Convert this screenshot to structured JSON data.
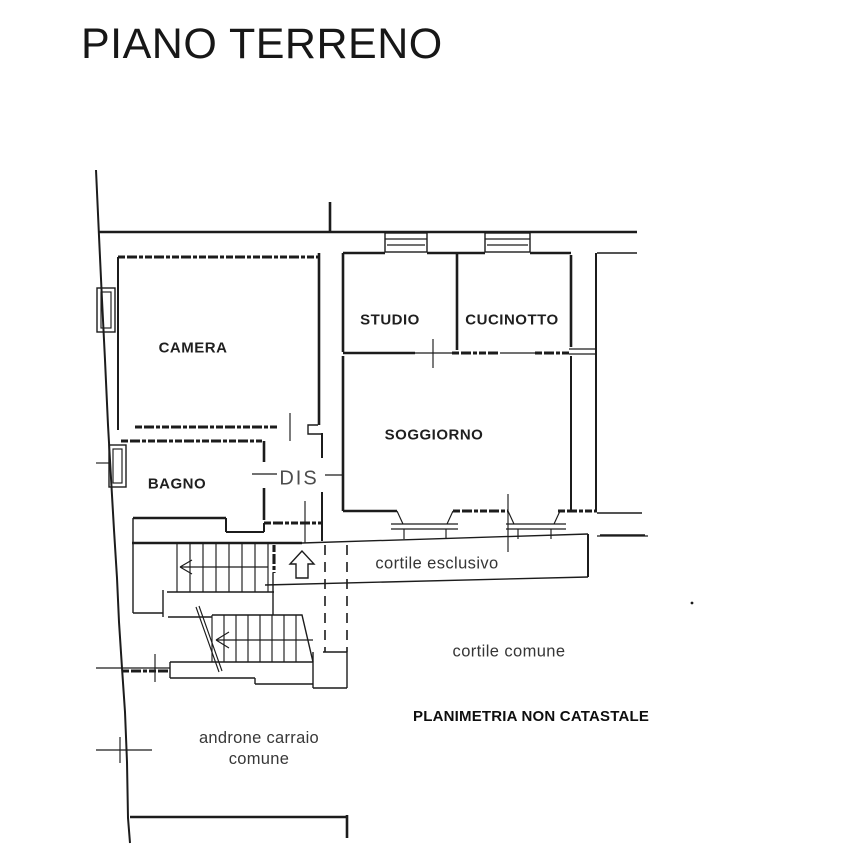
{
  "title": "PIANO TERRENO",
  "labels": {
    "camera": "CAMERA",
    "studio": "STUDIO",
    "cucinotto": "CUCINOTTO",
    "soggiorno": "SOGGIORNO",
    "bagno": "BAGNO",
    "dis": "DIS",
    "cortile_esclusivo": "cortile esclusivo",
    "cortile_comune": "cortile comune",
    "androne_line1": "androne carraio",
    "androne_line2": "comune",
    "note": "PLANIMETRIA NON CATASTALE"
  },
  "icons": {
    "entrance_up_arrow": "hollow block arrow pointing up (entrance direction)",
    "stair_up_arrow": "stair direction arrow pointing left",
    "stair_section_cut": "double diagonal cut line across lower flight"
  },
  "colors": {
    "ink": "#1c1c1c",
    "background": "#ffffff",
    "muted_text": "#4d4d4d"
  }
}
